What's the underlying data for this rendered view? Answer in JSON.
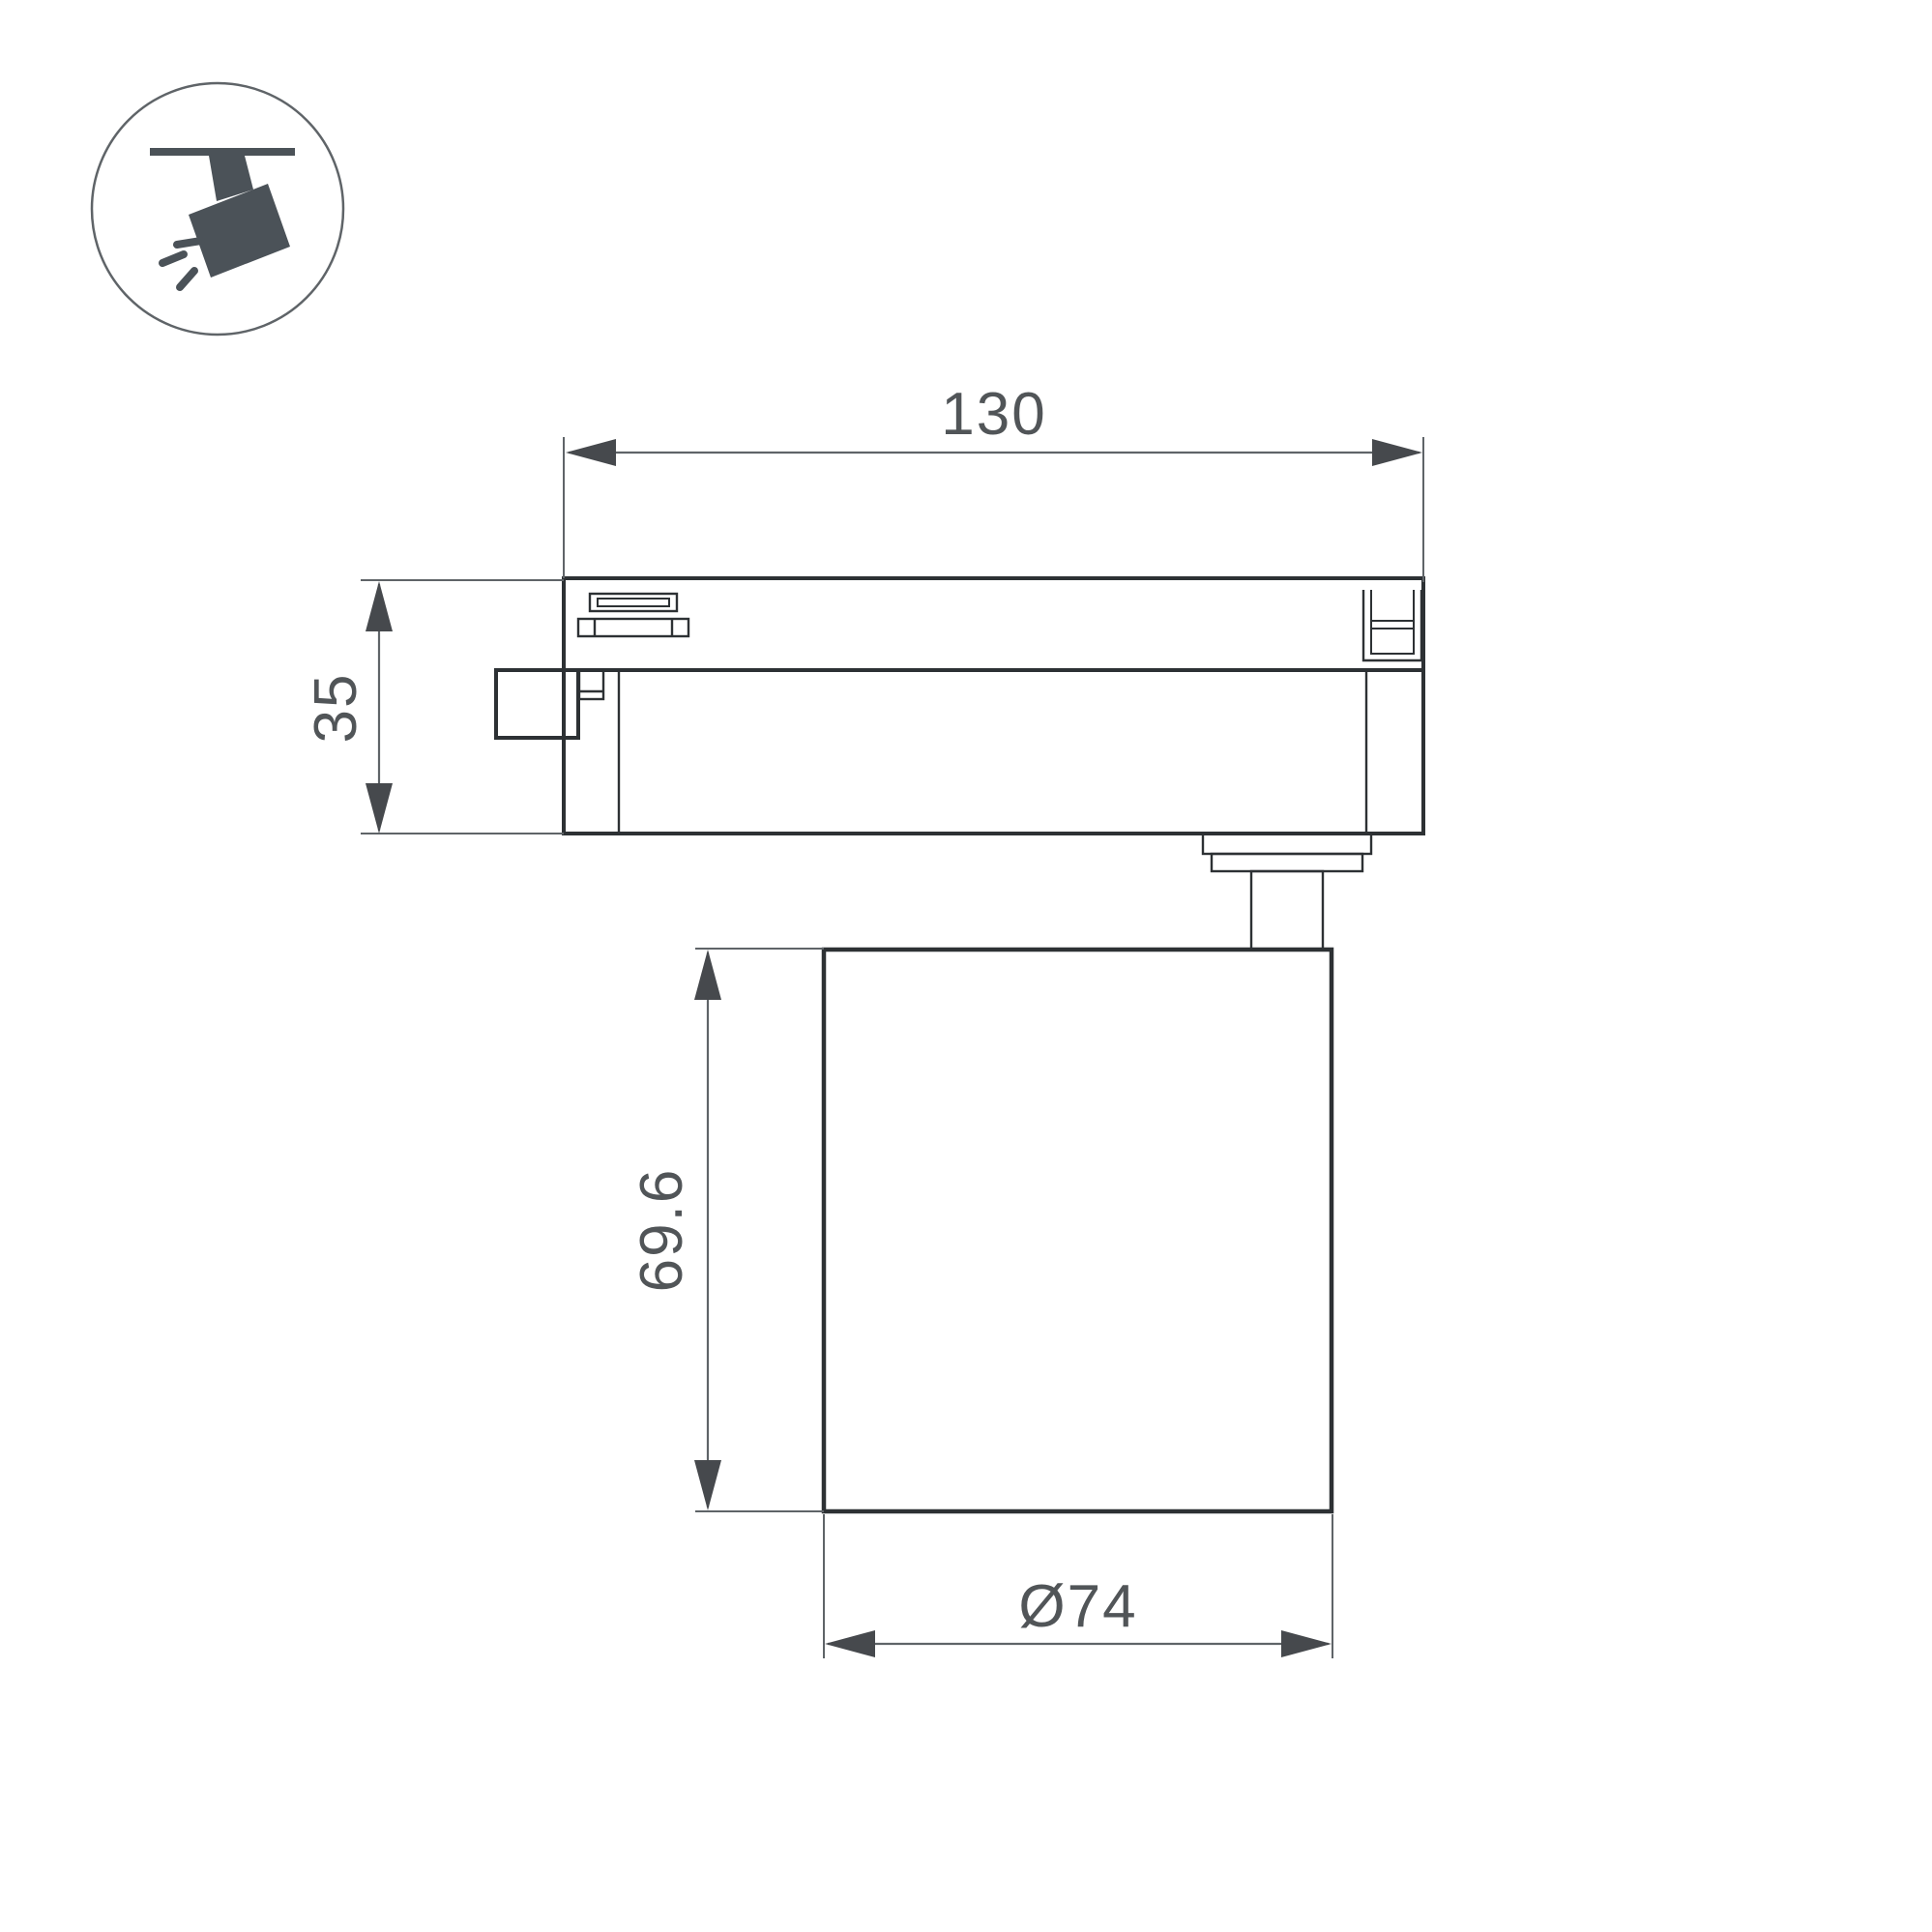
{
  "drawing": {
    "kind": "technical-dimension-drawing",
    "subject": "track-mounted-spotlight-side-view",
    "dimensions": {
      "track_length": {
        "value": "130"
      },
      "track_height": {
        "value": "35"
      },
      "body_height": {
        "value": "69.6"
      },
      "body_diameter": {
        "value": "Ø74"
      }
    },
    "icon": {
      "name": "track-spotlight-icon"
    },
    "colors": {
      "outline": "#2d3134",
      "dimension": "#5f6468",
      "arrow": "#46494d",
      "text": "#515558",
      "icon": "#4b5258",
      "background": "#ffffff"
    }
  }
}
